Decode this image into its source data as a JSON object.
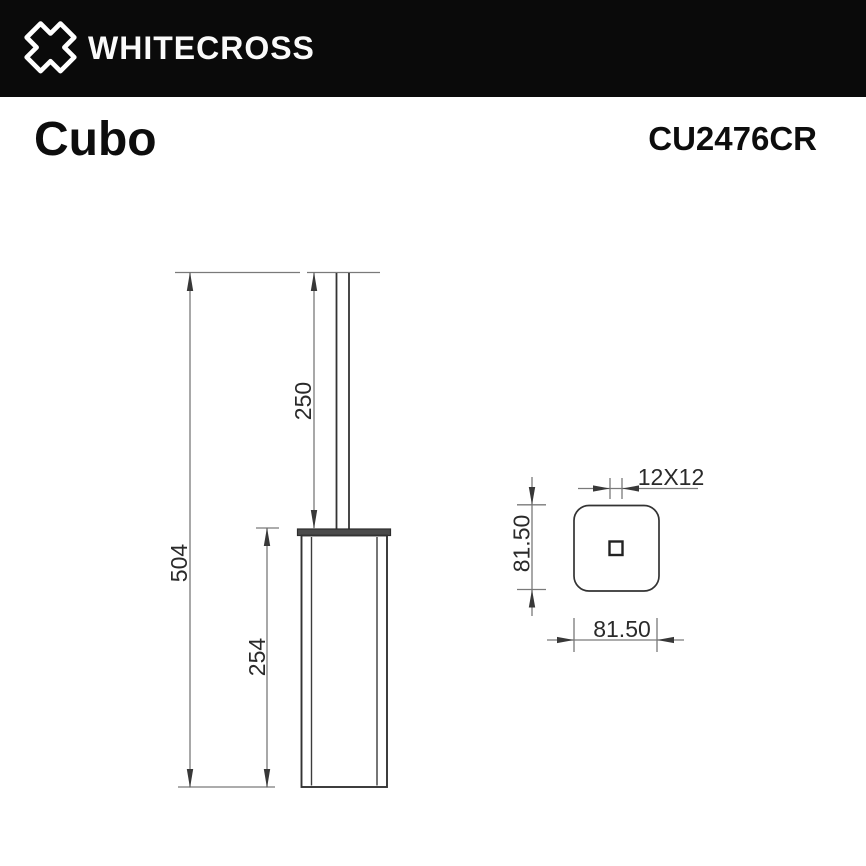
{
  "header": {
    "brand": "WHITECROSS"
  },
  "product": {
    "name": "Cubo",
    "model": "CU2476CR"
  },
  "drawing": {
    "front_view": {
      "label_total_height": "504",
      "label_handle_height": "250",
      "label_body_height": "254"
    },
    "top_view": {
      "label_handle_section": "12X12",
      "label_depth": "81.50",
      "label_width": "81.50"
    }
  },
  "colors": {
    "banner_bg": "#0a0a0a",
    "brand_text": "#fafafa",
    "object_line": "#333333",
    "dimension_line": "#7a7a7a",
    "cap_fill": "#4b4b4b",
    "label_text": "#2a2a2a"
  }
}
